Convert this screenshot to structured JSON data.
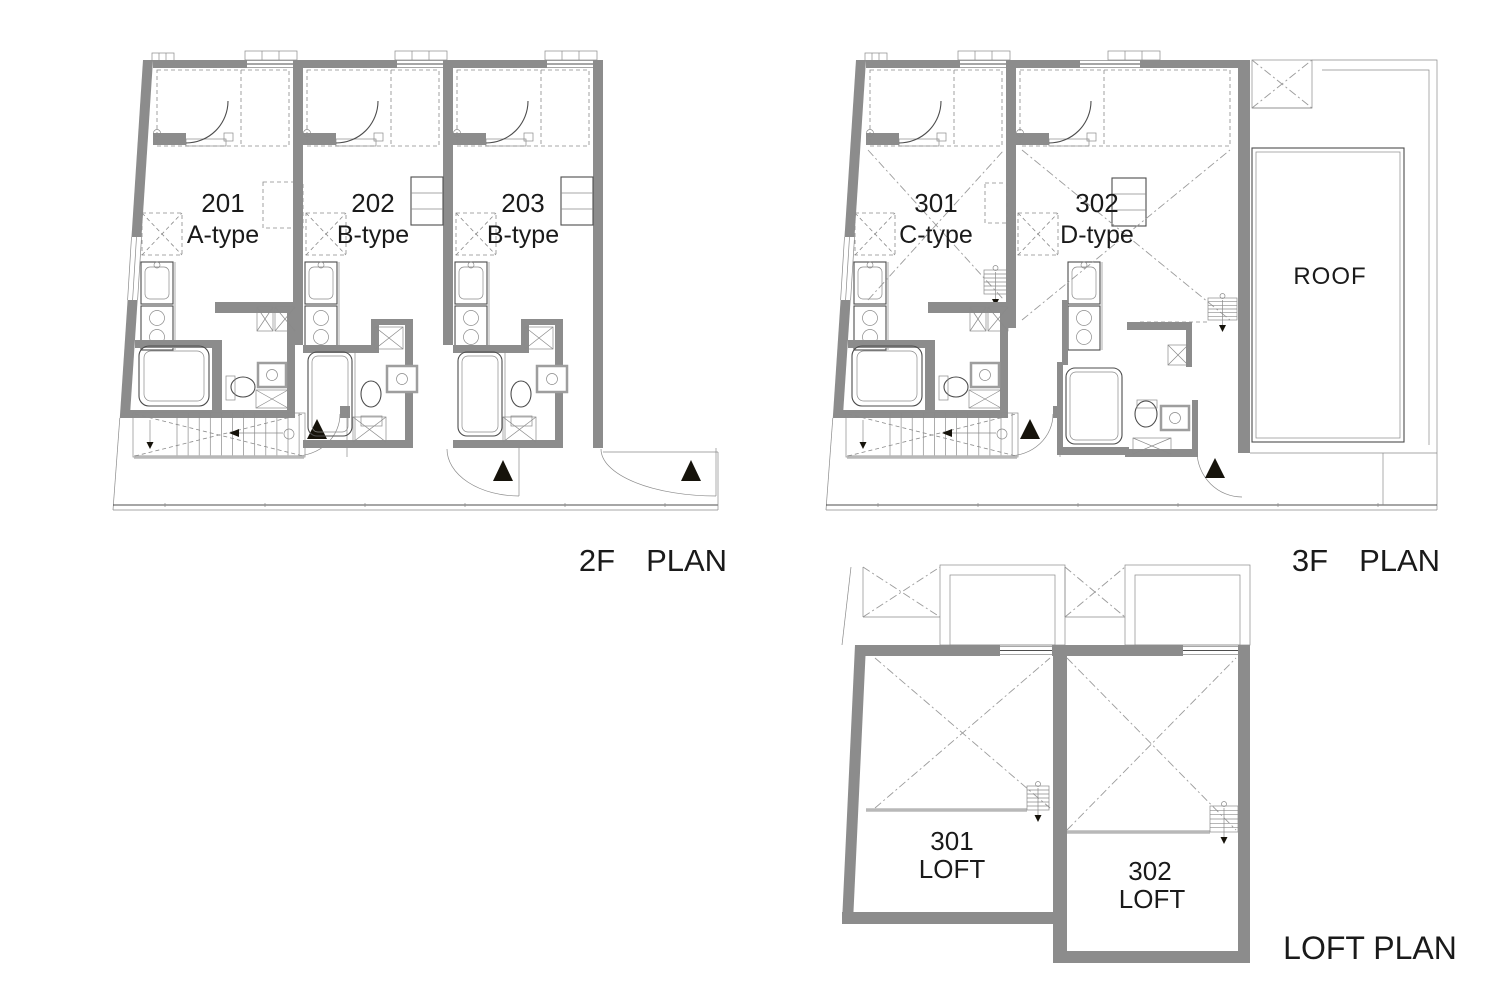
{
  "sheet": {
    "background": "#ffffff"
  },
  "colors": {
    "wall": "#8c8c8c",
    "ink": "#4d4d4d",
    "ink2": "#8a8a8a",
    "fixture": "#9e9e9e",
    "ddot": "#9b9b9b",
    "light": "#b8b8b8",
    "triangle": "#16130b",
    "text": "#1a1a1a"
  },
  "plans": {
    "floor2": {
      "title": "2F　PLAN",
      "units": [
        {
          "number": "201",
          "type": "A-type"
        },
        {
          "number": "202",
          "type": "B-type"
        },
        {
          "number": "203",
          "type": "B-type"
        }
      ]
    },
    "floor3": {
      "title": "3F　PLAN",
      "roof_label": "ROOF",
      "units": [
        {
          "number": "301",
          "type": "C-type"
        },
        {
          "number": "302",
          "type": "D-type"
        }
      ]
    },
    "loft": {
      "title": "LOFT PLAN",
      "units": [
        {
          "number": "301",
          "label": "LOFT"
        },
        {
          "number": "302",
          "label": "LOFT"
        }
      ]
    }
  }
}
